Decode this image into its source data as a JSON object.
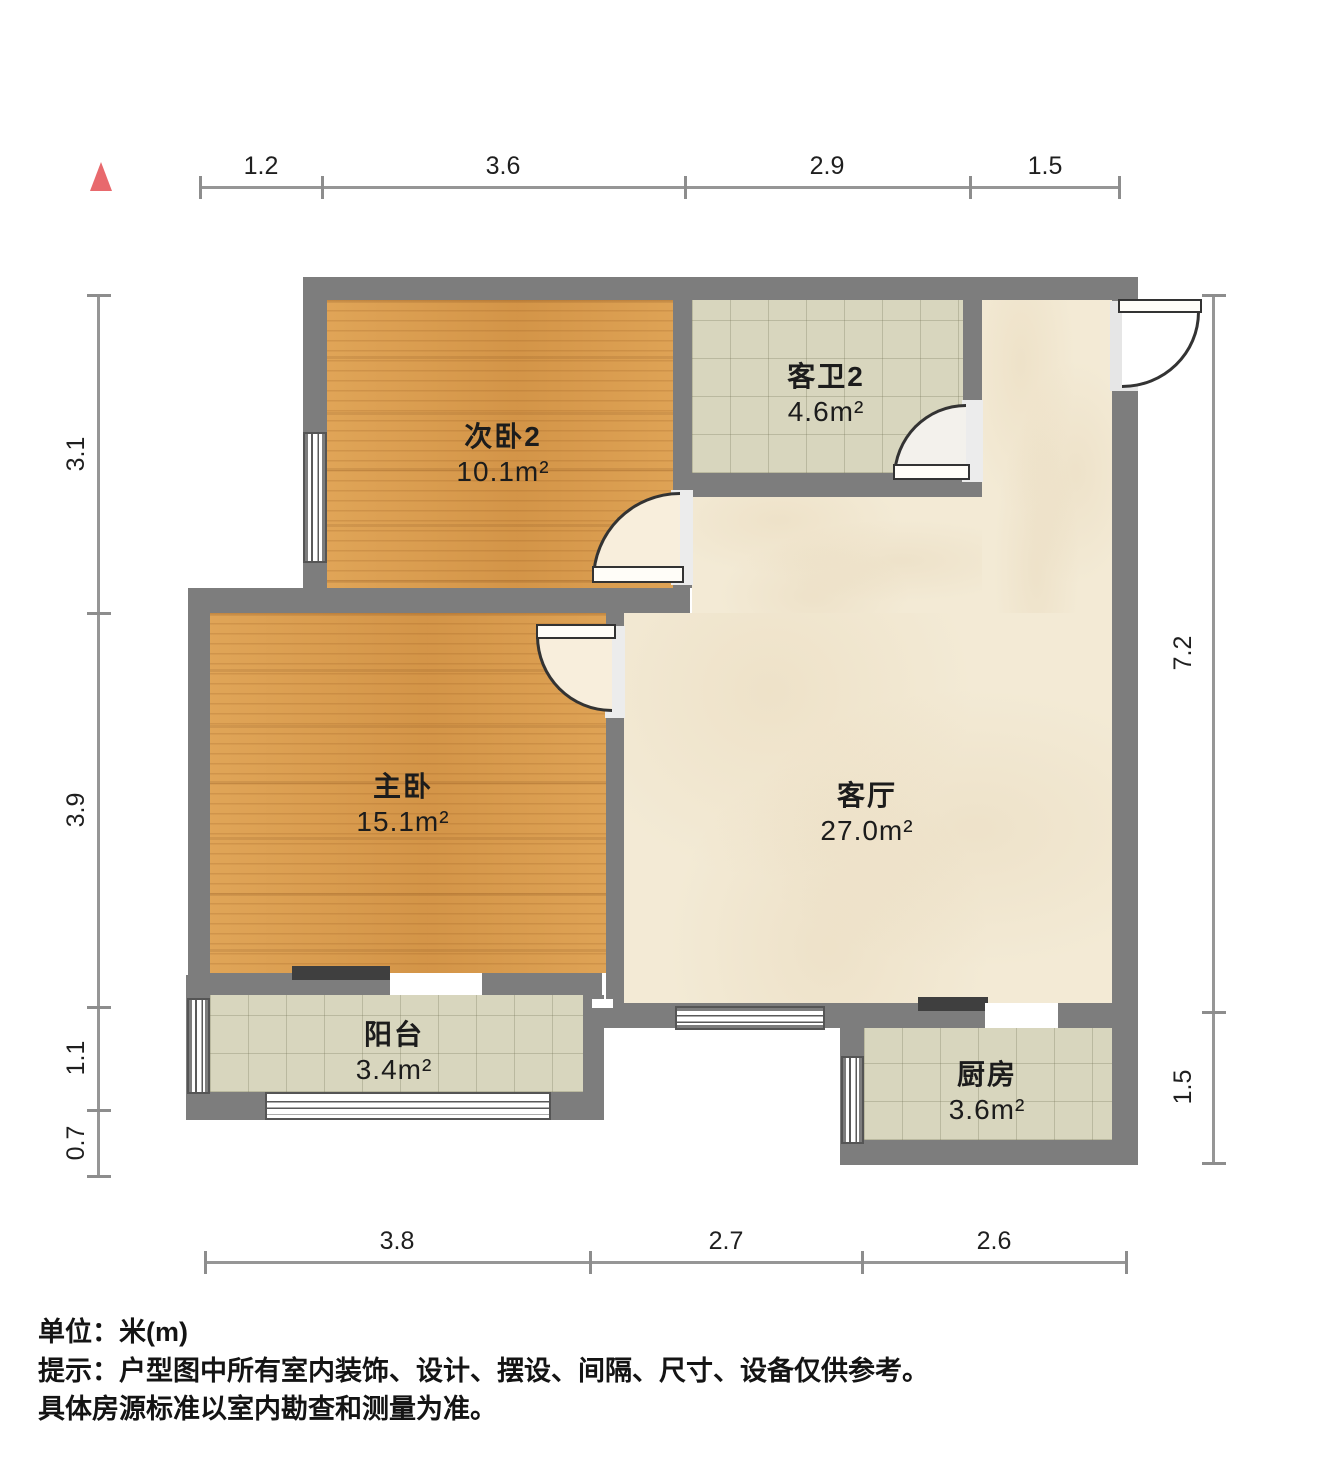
{
  "north_marker": {
    "icon": "north-triangle",
    "color": "#e8696d"
  },
  "rooms": [
    {
      "id": "second-bedroom",
      "name": "次卧2",
      "area": "10.1m²"
    },
    {
      "id": "guest-bathroom",
      "name": "客卫2",
      "area": "4.6m²"
    },
    {
      "id": "master-bedroom",
      "name": "主卧",
      "area": "15.1m²"
    },
    {
      "id": "living-room",
      "name": "客厅",
      "area": "27.0m²"
    },
    {
      "id": "balcony",
      "name": "阳台",
      "area": "3.4m²"
    },
    {
      "id": "kitchen",
      "name": "厨房",
      "area": "3.6m²"
    }
  ],
  "dimensions": {
    "top": [
      "1.2",
      "3.6",
      "2.9",
      "1.5"
    ],
    "left": [
      "3.1",
      "3.9",
      "1.1",
      "0.7"
    ],
    "right": [
      "7.2",
      "1.5"
    ],
    "bottom": [
      "3.8",
      "2.7",
      "2.6"
    ]
  },
  "footer": {
    "unit": "单位：米(m)",
    "tip": "提示：户型图中所有室内装饰、设计、摆设、间隔、尺寸、设备仅供参考。",
    "note": "具体房源标准以室内勘查和测量为准。"
  },
  "colors": {
    "wall": "#7d7d7d",
    "wood_floor": "#d99c4e",
    "tile_floor": "#d8d6be",
    "marble_floor": "#f3ead5",
    "north_marker": "#e8696d",
    "dimension_line": "#969696"
  }
}
